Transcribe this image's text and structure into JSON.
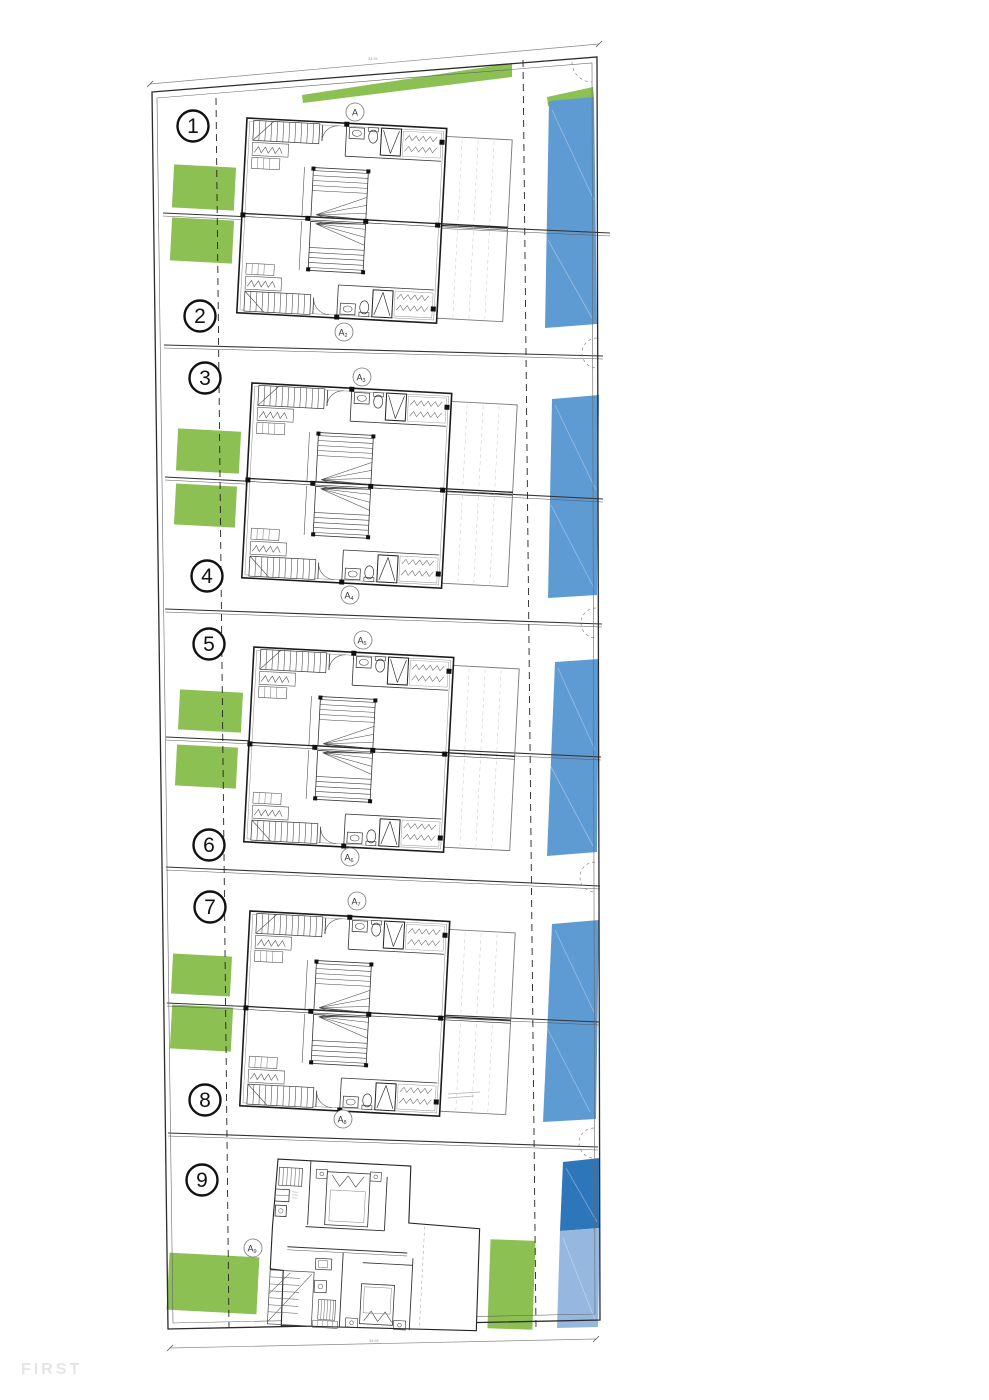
{
  "watermark": {
    "label": "FIRST"
  },
  "dimensions": {
    "top": "34.91",
    "bottom": "34.91"
  },
  "colors": {
    "garden_green": "#8cc053",
    "pool_blue": "#5f9bd3",
    "pool_blue_light": "#96b8e0",
    "pool_blue_dark": "#2e76ba",
    "watermark_gray": "#e5e5e5",
    "wall_dark": "#1b1b1b"
  },
  "units": [
    {
      "label": "1"
    },
    {
      "label": "2"
    },
    {
      "label": "3"
    },
    {
      "label": "4"
    },
    {
      "label": "5"
    },
    {
      "label": "6"
    },
    {
      "label": "7"
    },
    {
      "label": "8"
    },
    {
      "label": "9"
    }
  ],
  "section_markers": [
    {
      "label": "A",
      "sub": ""
    },
    {
      "label": "A",
      "sub": "2"
    },
    {
      "label": "A",
      "sub": "3"
    },
    {
      "label": "A",
      "sub": "4"
    },
    {
      "label": "A",
      "sub": "5"
    },
    {
      "label": "A",
      "sub": "6"
    },
    {
      "label": "A",
      "sub": "7"
    },
    {
      "label": "A",
      "sub": "8"
    },
    {
      "label": "A",
      "sub": "9"
    }
  ]
}
